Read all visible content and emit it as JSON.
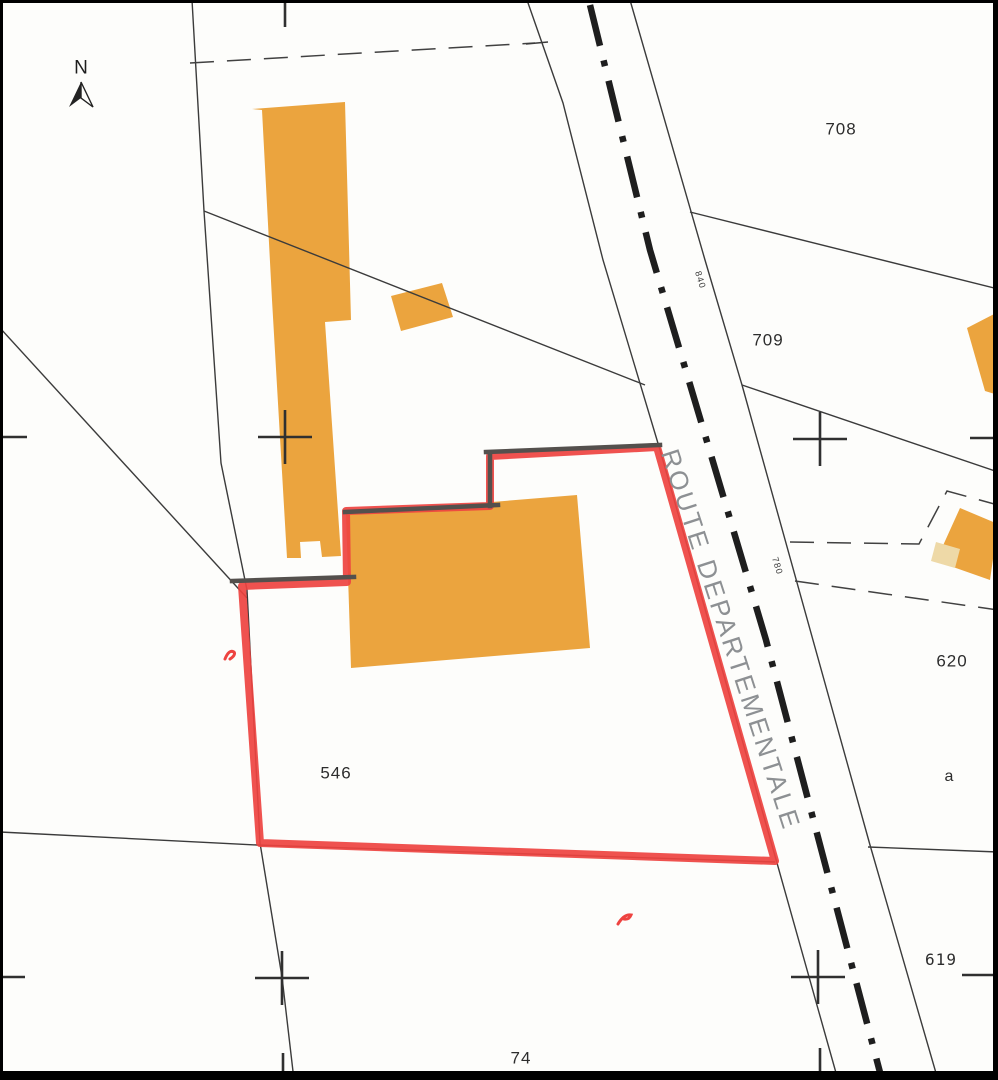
{
  "map": {
    "compass_label": "N",
    "road": {
      "name": "ROUTE DEPARTEMENTALE",
      "point_top": "840",
      "point_mid": "780"
    },
    "parcels": {
      "n708": "708",
      "n709": "709",
      "n620": "620",
      "sub_a": "a",
      "n619": "619",
      "n546": "546",
      "n74": "74"
    }
  },
  "colors": {
    "building_orange": "#eba43e",
    "building_light": "#eed9a7",
    "boundary_red": "#ee4340",
    "wall_gray": "#54504d",
    "line_dark": "#3b3b3b",
    "dash_dark": "#414141",
    "centerline_black": "#1e1e1e",
    "cross_dark": "#303030",
    "road_text_gray": "#8d9093",
    "label_dark": "#2d2d2d",
    "page_bg": "#fdfdfb"
  }
}
